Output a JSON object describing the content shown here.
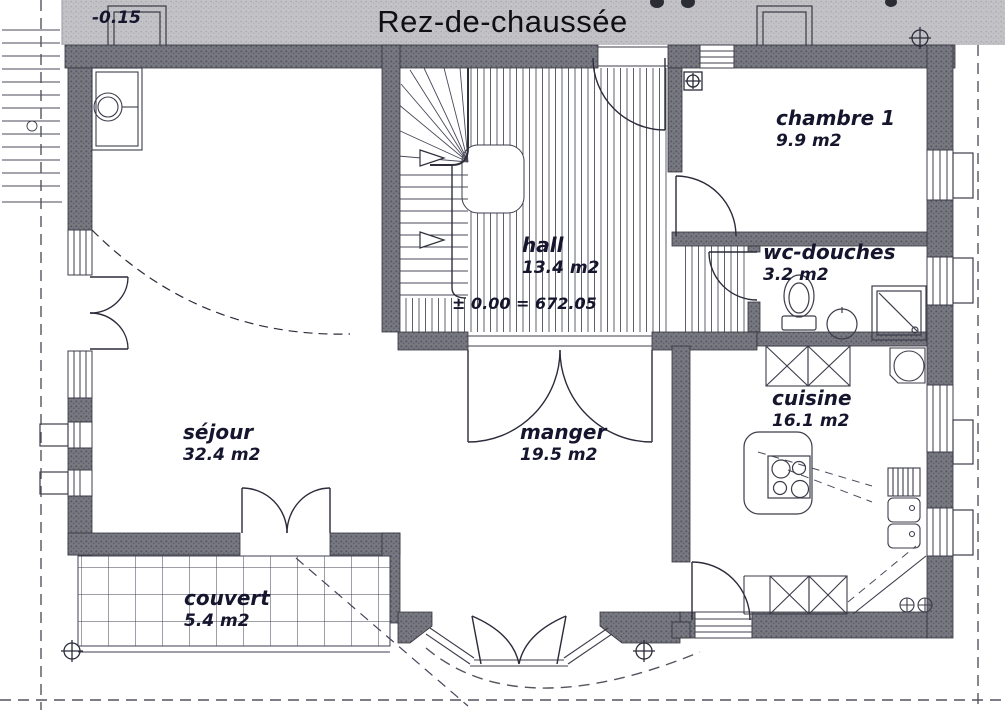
{
  "title": "Rez-de-chaussée",
  "elevation_marker": "-0.15",
  "rooms": [
    {
      "id": "sejour",
      "name": "séjour",
      "area": "32.4 m2"
    },
    {
      "id": "manger",
      "name": "manger",
      "area": "19.5 m2"
    },
    {
      "id": "hall",
      "name": "hall",
      "area": "13.4 m2",
      "elevation": "± 0.00 = 672.05"
    },
    {
      "id": "cuisine",
      "name": "cuisine",
      "area": "16.1 m2"
    },
    {
      "id": "chambre1",
      "name": "chambre 1",
      "area": "9.9 m2"
    },
    {
      "id": "wc",
      "name": "wc-douches",
      "area": "3.2 m2"
    },
    {
      "id": "couvert",
      "name": "couvert",
      "area": "5.4 m2"
    }
  ],
  "colors": {
    "wall": "#6e6e78",
    "band": "#bfbfc4",
    "ink": "#15152d"
  }
}
